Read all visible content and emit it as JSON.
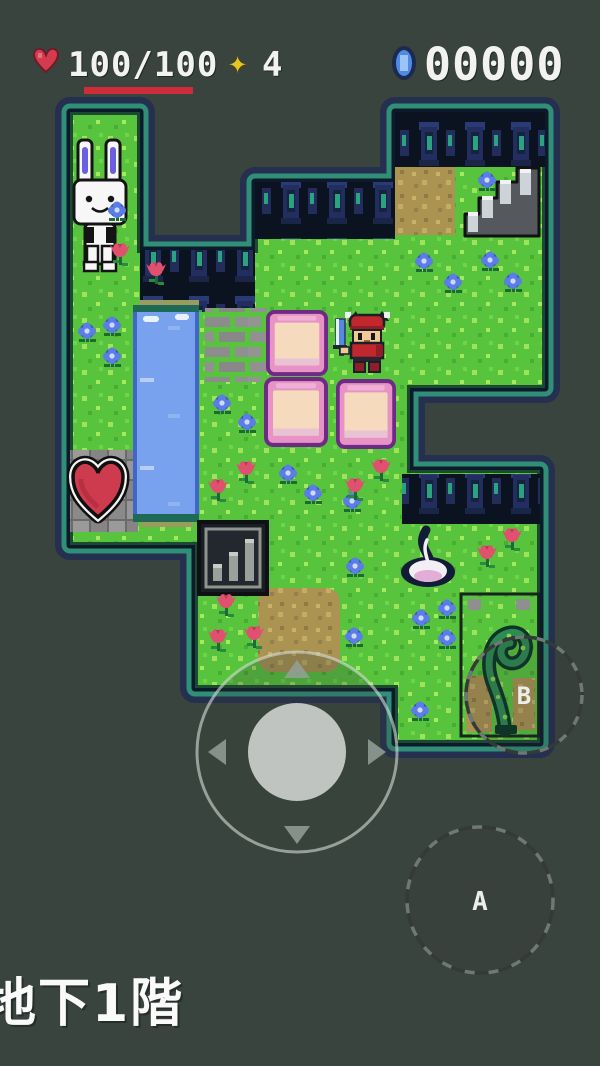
{
  "hud": {
    "heart_icon": "heart-icon",
    "hp_display": "100/100",
    "hp_current": "100",
    "hp_max": "100",
    "star_icon": "star-icon",
    "star_glyph": "✦",
    "star_count": "4",
    "gem_icon": "gem-icon",
    "gem_count": "00000",
    "hp_bar_color": "#cf2b38"
  },
  "controls": {
    "button_a_label": "A",
    "button_b_label": "B",
    "dpad_arrows": [
      "up",
      "down",
      "left",
      "right"
    ]
  },
  "floor": {
    "label": "地下1階"
  },
  "colors": {
    "background": "#3a443e",
    "grass": "#58c43d",
    "water": "#79a2ee",
    "glow_navy": "#222c52",
    "glow_teal": "#2f9077",
    "block_pink": "#e793c5",
    "heart_red": "#cf3b4e",
    "wall_dark": "#0b1220"
  },
  "map": {
    "objects": [
      "rabbit-npc",
      "heart-container",
      "water-channel",
      "brick-path",
      "pink-block",
      "pink-block",
      "pink-block",
      "player-character",
      "staircase",
      "dirt-patch",
      "grate-sign",
      "white-flame",
      "vine-sprout",
      "stone-wall-top-right",
      "stone-wall-middle",
      "stone-wall-left",
      "stone-wall-lower"
    ],
    "blue_flowers": [
      [
        117,
        212
      ],
      [
        87,
        333
      ],
      [
        112,
        327
      ],
      [
        112,
        358
      ],
      [
        222,
        405
      ],
      [
        247,
        424
      ],
      [
        288,
        475
      ],
      [
        313,
        495
      ],
      [
        352,
        503
      ],
      [
        424,
        263
      ],
      [
        453,
        284
      ],
      [
        490,
        262
      ],
      [
        513,
        283
      ],
      [
        487,
        182
      ],
      [
        355,
        568
      ],
      [
        354,
        638
      ],
      [
        421,
        620
      ],
      [
        447,
        610
      ],
      [
        447,
        640
      ],
      [
        420,
        712
      ]
    ],
    "tulip_flowers": [
      [
        120,
        253
      ],
      [
        156,
        272
      ],
      [
        218,
        489
      ],
      [
        246,
        471
      ],
      [
        355,
        488
      ],
      [
        381,
        469
      ],
      [
        226,
        604
      ],
      [
        254,
        636
      ],
      [
        218,
        639
      ],
      [
        487,
        555
      ],
      [
        512,
        538
      ]
    ]
  }
}
